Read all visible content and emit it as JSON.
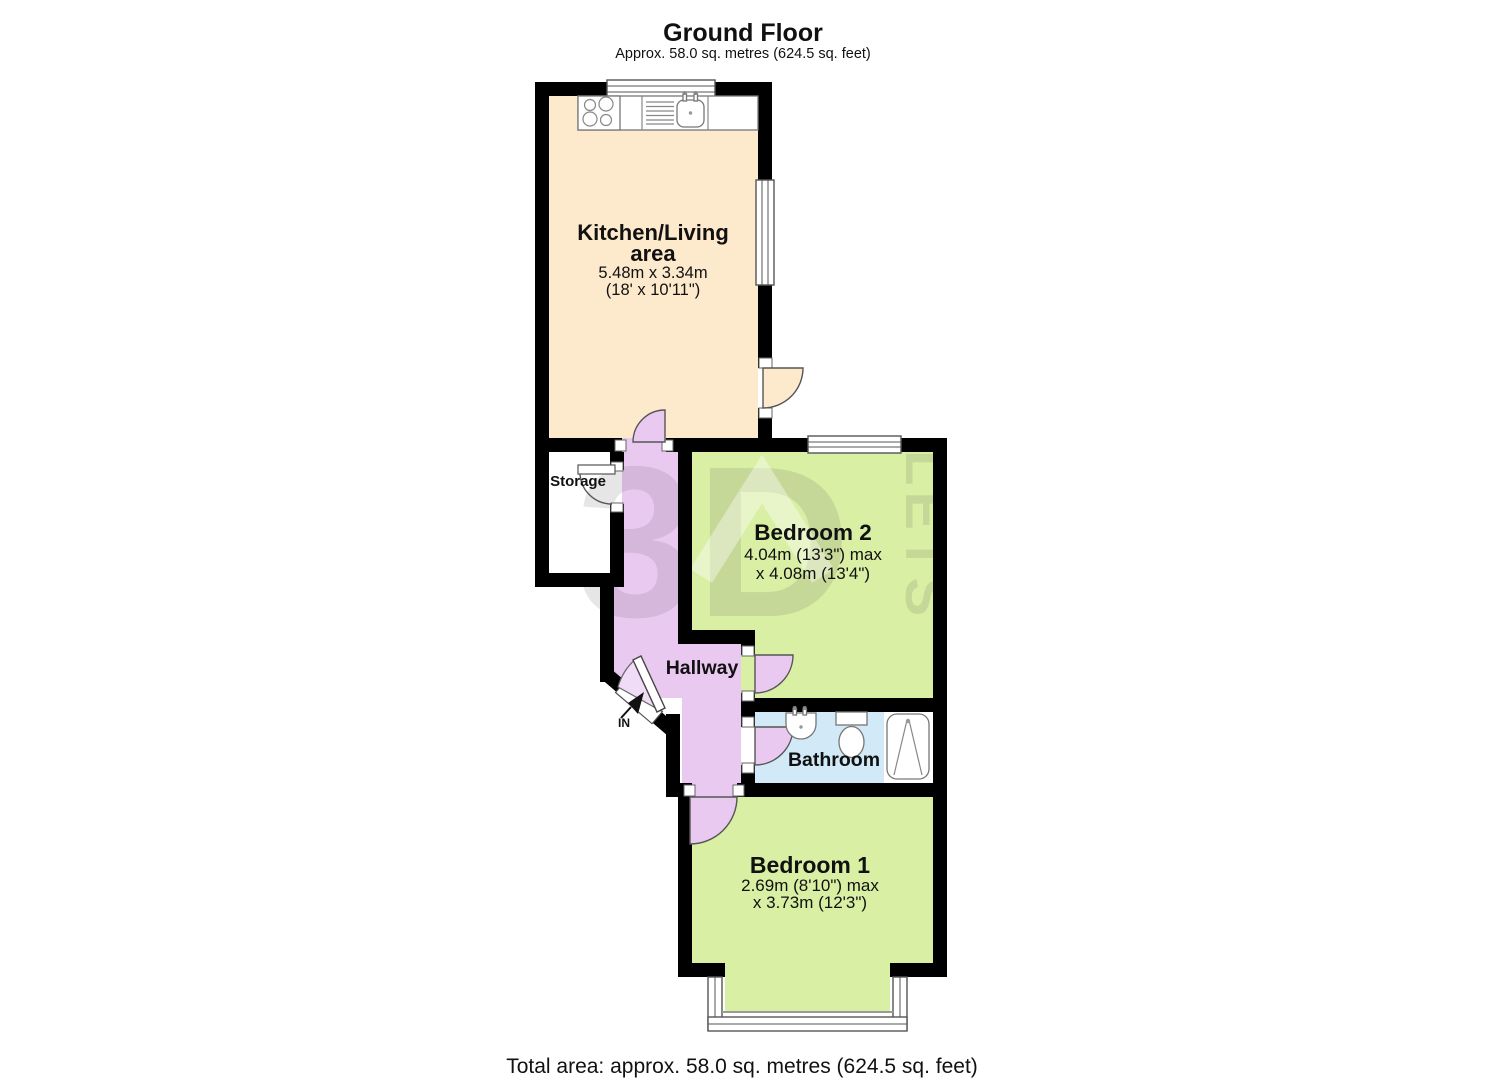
{
  "header": {
    "title": "Ground Floor",
    "subtitle": "Approx. 58.0 sq. metres (624.5 sq. feet)"
  },
  "footer": {
    "total_area": "Total area: approx. 58.0 sq. metres (624.5 sq. feet)"
  },
  "watermark": {
    "brand_3d": "3D",
    "brand_lets": "LETS"
  },
  "entrance": {
    "label": "IN"
  },
  "rooms": {
    "kitchen": {
      "name_line1": "Kitchen/Living",
      "name_line2": "area",
      "dim_metric": "5.48m x 3.34m",
      "dim_imperial": "(18' x 10'11\")",
      "color": "#fdeacd"
    },
    "storage": {
      "name": "Storage",
      "color": "#ffffff"
    },
    "bedroom2": {
      "name": "Bedroom 2",
      "dim_line1": "4.04m (13'3\") max",
      "dim_line2": "x 4.08m (13'4\")",
      "color": "#d9efa4"
    },
    "hallway": {
      "name": "Hallway",
      "color": "#eac9f1"
    },
    "bathroom": {
      "name": "Bathroom",
      "color": "#d2e9f7"
    },
    "bedroom1": {
      "name": "Bedroom 1",
      "dim_line1": "2.69m (8'10\") max",
      "dim_line2": "x 3.73m (12'3\")",
      "color": "#d9efa4"
    }
  },
  "colors": {
    "wall": "#000000",
    "door_arc": "#555555",
    "fixture": "#777777"
  }
}
